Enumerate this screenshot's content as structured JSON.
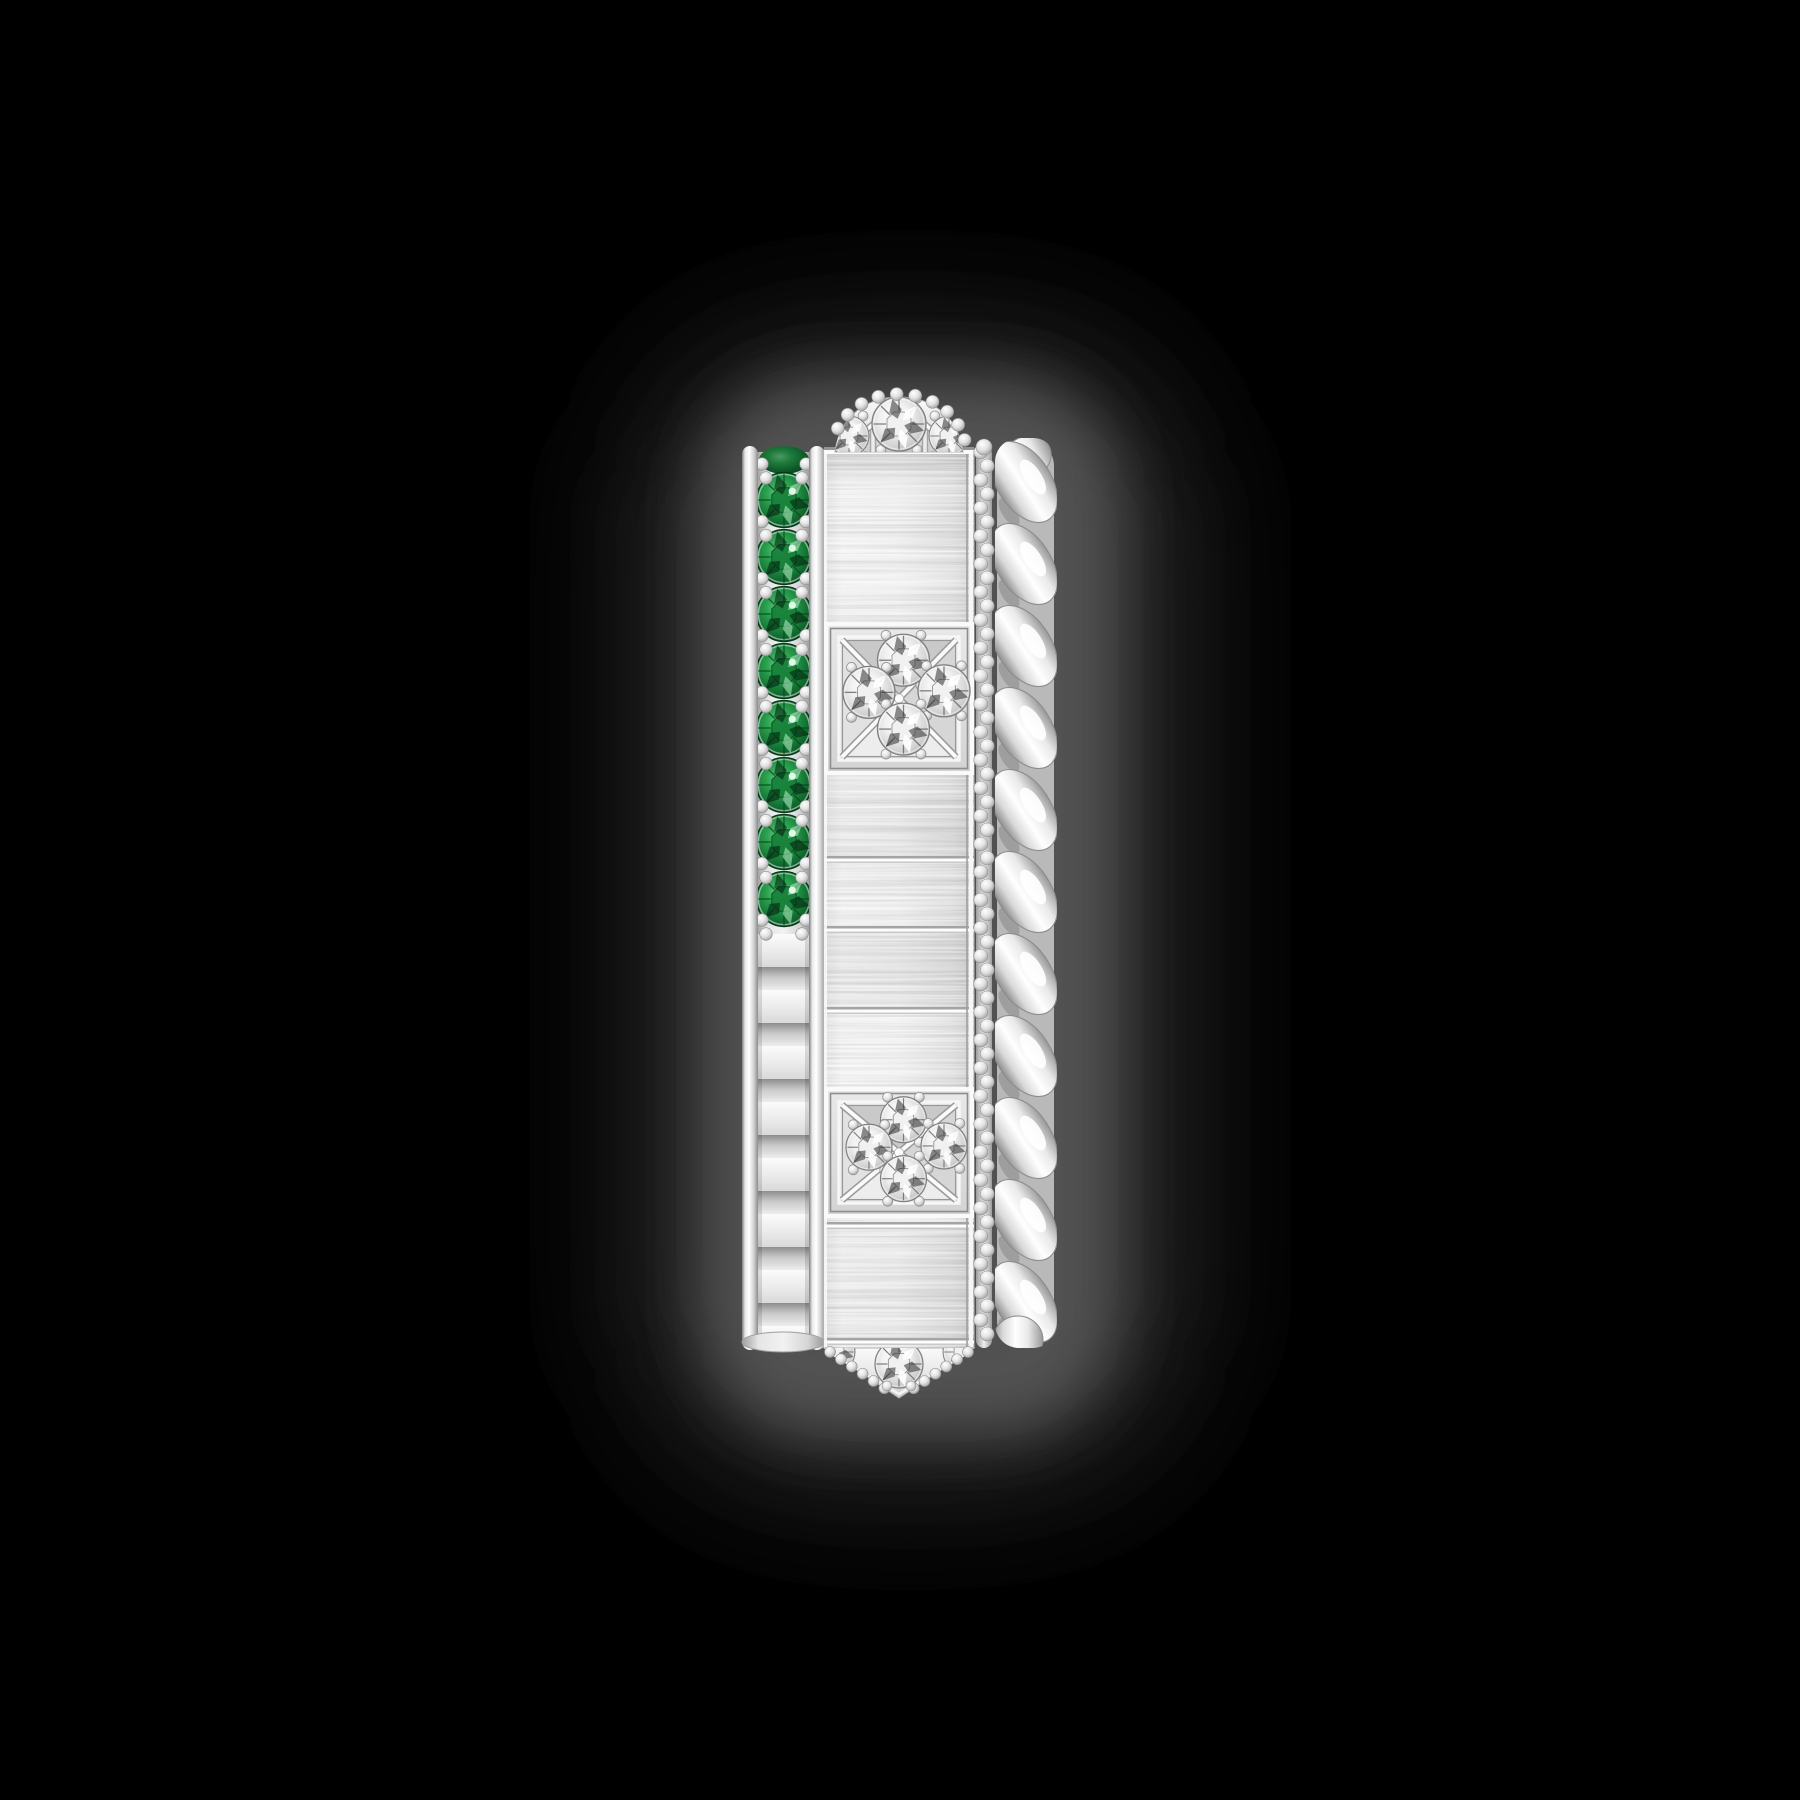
{
  "page": {
    "background_color": "#000000",
    "width": 1800,
    "height": 1800
  },
  "product_image": {
    "kind": "jewelry-product-photo",
    "subject": "side view of a wide white-metal band ring stacked from multiple bands: emerald pave band, faceted inner band, brushed band with diamond-set pyramid studs, beaded wire, twisted rope band",
    "visible_elements": {
      "emerald_stones": 9,
      "pyramid_studs_full": 2,
      "pyramid_studs_partial": 2,
      "diamonds_per_full_stud": 4,
      "rope_curls": 11
    },
    "palette": {
      "background": "#000000",
      "shadow_outer": "#343434",
      "shadow_inner": "#565656",
      "metal_white": "#ffffff",
      "metal_light": "#f2f2f2",
      "metal_mid": "#d9d9d9",
      "metal_dark": "#8e8e8e",
      "emerald_green": "#15803a",
      "emerald_deep": "#0a4c20",
      "diamond_white": "#ffffff",
      "diamond_shadow": "#2e2e2e"
    },
    "gradients": {
      "linear": {
        "lgRail": {
          "horizontal": true,
          "stops": [
            [
              0,
              "#7d7d7d"
            ],
            [
              0.2,
              "#e9e9e9"
            ],
            [
              0.45,
              "#ffffff"
            ],
            [
              0.75,
              "#cfcfcf"
            ],
            [
              1,
              "#8b8b8b"
            ]
          ]
        },
        "lgChannel": {
          "horizontal": true,
          "stops": [
            [
              0,
              "#9e9e9e"
            ],
            [
              0.2,
              "#e5e5e5"
            ],
            [
              0.5,
              "#f2f2f2"
            ],
            [
              0.8,
              "#d6d6d6"
            ],
            [
              1,
              "#9b9b9b"
            ]
          ]
        },
        "lgSlab": {
          "horizontal": true,
          "stops": [
            [
              0,
              "#dedede"
            ],
            [
              0.12,
              "#f0f0f0"
            ],
            [
              0.5,
              "#ececec"
            ],
            [
              0.85,
              "#dadada"
            ],
            [
              1,
              "#c6c6c6"
            ]
          ]
        },
        "lgBevel": {
          "horizontal": false,
          "stops": [
            [
              0,
              "#8d8d8d"
            ],
            [
              0.45,
              "#c9c9c9"
            ],
            [
              1,
              "#ededed"
            ]
          ]
        },
        "lgBright": {
          "horizontal": false,
          "stops": [
            [
              0,
              "#fbfbfb"
            ],
            [
              0.5,
              "#ececec"
            ],
            [
              1,
              "#d9d9d9"
            ]
          ]
        },
        "lgRope": {
          "horizontal": true,
          "stops": [
            [
              0,
              "#8f8f8f"
            ],
            [
              0.2,
              "#d9d9d9"
            ],
            [
              0.45,
              "#ffffff"
            ],
            [
              0.7,
              "#e9e9e9"
            ],
            [
              1,
              "#989898"
            ]
          ]
        },
        "lgDome": {
          "horizontal": false,
          "stops": [
            [
              0,
              "#fafafa"
            ],
            [
              0.6,
              "#e4e4e4"
            ],
            [
              1,
              "#cdcdcd"
            ]
          ]
        },
        "lgStud": {
          "horizontal": false,
          "stops": [
            [
              0,
              "#e9e9e9"
            ],
            [
              1,
              "#d3d3d3"
            ]
          ]
        },
        "lgChain": {
          "horizontal": true,
          "stops": [
            [
              0,
              "#9c9c9c"
            ],
            [
              0.5,
              "#eeeeee"
            ],
            [
              1,
              "#9c9c9c"
            ]
          ]
        },
        "lgTopShade": {
          "horizontal": false,
          "stops": [
            [
              0,
              "#97979b",
              0.55
            ],
            [
              1,
              "#97979b",
              0
            ]
          ]
        }
      },
      "radial": {
        "rDia": {
          "cx": 0.42,
          "cy": 0.38,
          "stops": [
            [
              0,
              "#ffffff"
            ],
            [
              0.35,
              "#f1f1f1"
            ],
            [
              0.7,
              "#d0d0d0"
            ],
            [
              1,
              "#a8a8a8"
            ]
          ]
        },
        "rEme": {
          "cx": 0.42,
          "cy": 0.38,
          "stops": [
            [
              0,
              "#6fd28b"
            ],
            [
              0.3,
              "#2ba350"
            ],
            [
              0.65,
              "#117031"
            ],
            [
              0.9,
              "#0a4c20"
            ],
            [
              1,
              "#07391a"
            ]
          ]
        },
        "rBead": {
          "cx": 0.38,
          "cy": 0.32,
          "stops": [
            [
              0,
              "#ffffff"
            ],
            [
              0.5,
              "#e2e2e2"
            ],
            [
              1,
              "#9a9a9a"
            ]
          ]
        }
      }
    },
    "geometry": {
      "shadow": {
        "outer": {
          "x": 636,
          "y": 336,
          "w": 548,
          "h": 1148,
          "rx": 180,
          "opacity": 0.85
        },
        "inner": {
          "x": 702,
          "y": 378,
          "w": 416,
          "h": 1056,
          "rx": 120,
          "opacity": 0.9
        }
      },
      "left_band": {
        "outer_rail": {
          "x": 742,
          "y": 446,
          "w": 16,
          "h": 904
        },
        "inner_rail": {
          "x": 809,
          "y": 446,
          "w": 16,
          "h": 904
        },
        "channel": {
          "x": 757,
          "y": 452,
          "w": 53,
          "h": 892
        },
        "partial_stone": {
          "cx": 784,
          "cy": 460,
          "rx": 25,
          "ry": 14
        },
        "stone_cx": 784,
        "stone_r": 27.5,
        "stone_centers": [
          500,
          557,
          614,
          671,
          728,
          785,
          842,
          899
        ],
        "bead_r": 6.3,
        "facets": {
          "x": 757,
          "y": 934,
          "w": 53,
          "h": 404,
          "bright_h": 33,
          "bevel_h": 23
        },
        "bottom_cap": {
          "cx": 783,
          "cy": 1342,
          "rx": 41,
          "ry": 10
        }
      },
      "slab": {
        "x": 824,
        "y": 450,
        "w": 150,
        "h": 898,
        "top_shade_h": 28
      },
      "seams": [
        858,
        928,
        1009,
        1224,
        1340
      ],
      "block_tints": [
        {
          "y": 775,
          "h": 83,
          "o": 0.03
        },
        {
          "y": 928,
          "h": 81,
          "o": 0.04
        },
        {
          "y": 1227,
          "h": 113,
          "o": 0.025
        }
      ],
      "studs": [
        {
          "x": 824,
          "y": 622,
          "w": 150,
          "h": 153,
          "gem_r": 26
        },
        {
          "x": 824,
          "y": 1087,
          "w": 150,
          "h": 131,
          "gem_r": 23
        }
      ],
      "stud_gem_offsets": [
        [
          0.03,
          -0.25
        ],
        [
          -0.2,
          -0.04
        ],
        [
          0.3,
          -0.05
        ],
        [
          0.03,
          0.2
        ]
      ],
      "dome": {
        "cx": 899,
        "top_y": 397,
        "base_y": 452,
        "half_w": 64,
        "gems": [
          {
            "dx": 0,
            "dy": -28,
            "r": 27
          },
          {
            "dx": -50,
            "dy": -16,
            "r": 20
          },
          {
            "dx": 50,
            "dy": -16,
            "r": 20
          }
        ],
        "strut_dx": [
          -46,
          -26,
          26,
          46
        ],
        "bead_r": 6.5
      },
      "chevron": {
        "x1": 824,
        "x2": 974,
        "y": 1348,
        "tip_x": 899,
        "tip_y": 1398,
        "gems": [
          {
            "x": 899,
            "y": 1364,
            "r": 24
          },
          {
            "x": 835,
            "y": 1352,
            "r": 20
          },
          {
            "x": 963,
            "y": 1352,
            "r": 20
          }
        ],
        "bead_r": 5.5
      },
      "chain": {
        "x": 984,
        "y0": 452,
        "y1": 1338,
        "step": 14,
        "r": 7,
        "zigzag": 3.2,
        "bg": {
          "x": 976,
          "y": 446,
          "w": 16,
          "h": 902
        }
      },
      "rope": {
        "cx": 1024,
        "y0": 482,
        "pitch": 82,
        "count": 11,
        "rx": 27,
        "ry": 45,
        "angle": -33,
        "bg": {
          "x": 997,
          "y": 440,
          "w": 57,
          "h": 906,
          "rx": 26
        },
        "clip": {
          "x": 995,
          "y": 438,
          "w": 62,
          "h": 910,
          "rx": 24
        }
      }
    }
  }
}
